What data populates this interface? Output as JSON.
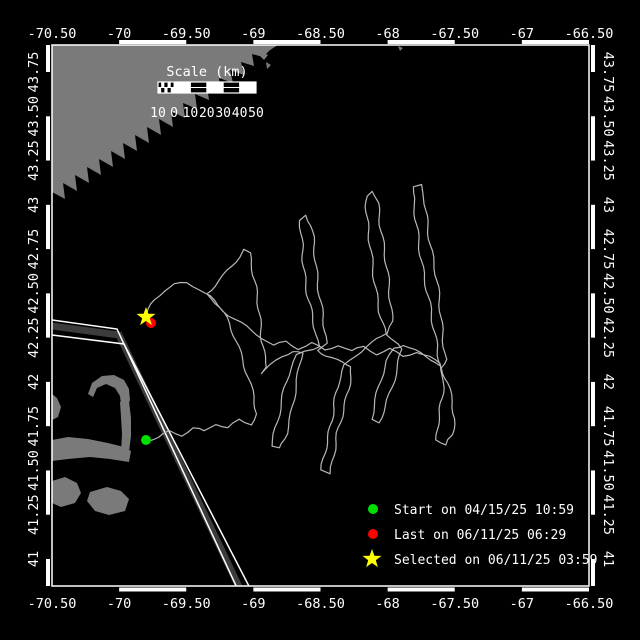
{
  "window": {
    "width": 640,
    "height": 640,
    "background": "#000000"
  },
  "axes": {
    "color": "#ffffff",
    "lon_labels": [
      "-70.50",
      "-70",
      "-69.50",
      "-69",
      "-68.50",
      "-68",
      "-67.50",
      "-67",
      "-66.50"
    ],
    "lat_labels_top_to_bottom": [
      "43.75",
      "43.50",
      "43.25",
      "43",
      "42.75",
      "42.50",
      "42.25",
      "42",
      "41.75",
      "41.50",
      "41.25",
      "41"
    ]
  },
  "scalebar": {
    "title": "Scale (km)",
    "edge_label": "10",
    "zero_label": "0",
    "tick_labels": [
      "10",
      "20",
      "30",
      "40",
      "50"
    ]
  },
  "legend": {
    "items": [
      {
        "marker": "dot",
        "color": "#00e000",
        "label": "Start on 04/15/25 10:59"
      },
      {
        "marker": "dot",
        "color": "#ff0000",
        "label": "Last on 06/11/25 06:29"
      },
      {
        "marker": "star",
        "color": "#ffff00",
        "label": "Selected on 06/11/25 03:59"
      }
    ]
  },
  "map": {
    "land_color": "#7a7a7a",
    "track_color": "#b8b8b8",
    "lane_line_color": "#ffffff",
    "lane_zone_color": "#3c3c3c",
    "markers": {
      "start": {
        "x": 146,
        "y": 440,
        "color": "#00e000"
      },
      "last": {
        "x": 151,
        "y": 323,
        "color": "#ff0000"
      },
      "selected": {
        "x": 146,
        "y": 317,
        "color": "#ffff00"
      }
    },
    "land_polygons": [
      [
        [
          52,
          45
        ],
        [
          278,
          45
        ],
        [
          270,
          50
        ],
        [
          263,
          57
        ],
        [
          252,
          54
        ],
        [
          254,
          66
        ],
        [
          241,
          62
        ],
        [
          244,
          75
        ],
        [
          230,
          70
        ],
        [
          233,
          83
        ],
        [
          219,
          78
        ],
        [
          221,
          92
        ],
        [
          207,
          86
        ],
        [
          209,
          100
        ],
        [
          195,
          94
        ],
        [
          197,
          109
        ],
        [
          183,
          103
        ],
        [
          185,
          118
        ],
        [
          171,
          111
        ],
        [
          173,
          127
        ],
        [
          159,
          119
        ],
        [
          161,
          135
        ],
        [
          147,
          127
        ],
        [
          149,
          143
        ],
        [
          135,
          135
        ],
        [
          137,
          151
        ],
        [
          123,
          143
        ],
        [
          125,
          159
        ],
        [
          111,
          151
        ],
        [
          113,
          167
        ],
        [
          99,
          159
        ],
        [
          101,
          175
        ],
        [
          87,
          167
        ],
        [
          89,
          183
        ],
        [
          75,
          175
        ],
        [
          77,
          191
        ],
        [
          63,
          183
        ],
        [
          65,
          199
        ],
        [
          52,
          192
        ]
      ],
      [
        [
          262,
          52
        ],
        [
          268,
          55
        ],
        [
          264,
          60
        ],
        [
          260,
          56
        ]
      ],
      [
        [
          266,
          62
        ],
        [
          271,
          65
        ],
        [
          267,
          69
        ]
      ],
      [
        [
          398,
          46
        ],
        [
          403,
          48
        ],
        [
          400,
          51
        ]
      ],
      [
        [
          52,
          394
        ],
        [
          57,
          398
        ],
        [
          61,
          407
        ],
        [
          58,
          417
        ],
        [
          52,
          420
        ]
      ],
      [
        [
          88,
          394
        ],
        [
          92,
          383
        ],
        [
          102,
          376
        ],
        [
          114,
          375
        ],
        [
          124,
          380
        ],
        [
          129,
          389
        ],
        [
          130,
          400
        ],
        [
          128,
          405
        ],
        [
          121,
          404
        ],
        [
          120,
          396
        ],
        [
          115,
          388
        ],
        [
          106,
          384
        ],
        [
          97,
          388
        ],
        [
          93,
          397
        ]
      ],
      [
        [
          120,
          402
        ],
        [
          129,
          401
        ],
        [
          131,
          418
        ],
        [
          131,
          436
        ],
        [
          129,
          452
        ],
        [
          121,
          453
        ],
        [
          122,
          434
        ],
        [
          121,
          417
        ]
      ],
      [
        [
          52,
          440
        ],
        [
          68,
          437
        ],
        [
          88,
          439
        ],
        [
          108,
          443
        ],
        [
          124,
          447
        ],
        [
          131,
          451
        ],
        [
          129,
          462
        ],
        [
          110,
          459
        ],
        [
          90,
          457
        ],
        [
          68,
          459
        ],
        [
          52,
          461
        ]
      ],
      [
        [
          52,
          481
        ],
        [
          65,
          477
        ],
        [
          77,
          483
        ],
        [
          81,
          493
        ],
        [
          75,
          503
        ],
        [
          61,
          507
        ],
        [
          52,
          503
        ]
      ],
      [
        [
          90,
          492
        ],
        [
          107,
          487
        ],
        [
          121,
          491
        ],
        [
          129,
          499
        ],
        [
          125,
          511
        ],
        [
          109,
          515
        ],
        [
          95,
          511
        ],
        [
          87,
          501
        ]
      ]
    ],
    "shipping_lane": {
      "line_a": [
        [
          52,
          320
        ],
        [
          117,
          329
        ],
        [
          238,
          590
        ]
      ],
      "zone": [
        [
          52,
          326
        ],
        [
          119,
          335
        ],
        [
          241,
          591
        ]
      ],
      "line_b": [
        [
          52,
          335
        ],
        [
          124,
          344
        ],
        [
          252,
          592
        ]
      ]
    },
    "track_waypoints": [
      [
        146,
        440
      ],
      [
        158,
        437
      ],
      [
        169,
        431
      ],
      [
        181,
        435
      ],
      [
        193,
        428
      ],
      [
        205,
        432
      ],
      [
        216,
        424
      ],
      [
        228,
        428
      ],
      [
        239,
        420
      ],
      [
        250,
        424
      ],
      [
        256,
        414
      ],
      [
        254,
        397
      ],
      [
        249,
        378
      ],
      [
        243,
        359
      ],
      [
        236,
        341
      ],
      [
        229,
        324
      ],
      [
        220,
        308
      ],
      [
        212,
        298
      ],
      [
        207,
        294
      ],
      [
        215,
        286
      ],
      [
        224,
        276
      ],
      [
        232,
        266
      ],
      [
        239,
        256
      ],
      [
        244,
        249
      ],
      [
        250,
        253
      ],
      [
        253,
        270
      ],
      [
        256,
        292
      ],
      [
        259,
        314
      ],
      [
        262,
        336
      ],
      [
        265,
        357
      ],
      [
        267,
        368
      ],
      [
        261,
        373
      ],
      [
        271,
        366
      ],
      [
        282,
        357
      ],
      [
        293,
        351
      ],
      [
        302,
        353
      ],
      [
        299,
        373
      ],
      [
        295,
        393
      ],
      [
        291,
        413
      ],
      [
        286,
        433
      ],
      [
        279,
        449
      ],
      [
        271,
        446
      ],
      [
        275,
        428
      ],
      [
        280,
        408
      ],
      [
        285,
        388
      ],
      [
        291,
        368
      ],
      [
        297,
        356
      ],
      [
        305,
        352
      ],
      [
        313,
        349
      ],
      [
        318,
        347
      ],
      [
        314,
        327
      ],
      [
        310,
        305
      ],
      [
        306,
        283
      ],
      [
        303,
        261
      ],
      [
        301,
        239
      ],
      [
        300,
        221
      ],
      [
        306,
        215
      ],
      [
        311,
        226
      ],
      [
        314,
        248
      ],
      [
        317,
        272
      ],
      [
        320,
        296
      ],
      [
        323,
        320
      ],
      [
        326,
        342
      ],
      [
        318,
        350
      ],
      [
        326,
        355
      ],
      [
        337,
        360
      ],
      [
        347,
        364
      ],
      [
        352,
        367
      ],
      [
        348,
        389
      ],
      [
        343,
        411
      ],
      [
        338,
        433
      ],
      [
        334,
        455
      ],
      [
        330,
        474
      ],
      [
        322,
        470
      ],
      [
        326,
        448
      ],
      [
        330,
        426
      ],
      [
        334,
        404
      ],
      [
        339,
        382
      ],
      [
        345,
        366
      ],
      [
        355,
        356
      ],
      [
        366,
        346
      ],
      [
        377,
        339
      ],
      [
        385,
        334
      ],
      [
        380,
        312
      ],
      [
        376,
        288
      ],
      [
        372,
        264
      ],
      [
        369,
        240
      ],
      [
        367,
        217
      ],
      [
        367,
        196
      ],
      [
        373,
        191
      ],
      [
        378,
        203
      ],
      [
        381,
        225
      ],
      [
        384,
        249
      ],
      [
        387,
        273
      ],
      [
        390,
        297
      ],
      [
        393,
        321
      ],
      [
        388,
        334
      ],
      [
        394,
        342
      ],
      [
        401,
        349
      ],
      [
        397,
        367
      ],
      [
        392,
        387
      ],
      [
        386,
        407
      ],
      [
        379,
        423
      ],
      [
        371,
        419
      ],
      [
        376,
        400
      ],
      [
        381,
        380
      ],
      [
        387,
        361
      ],
      [
        394,
        348
      ],
      [
        404,
        344
      ],
      [
        415,
        350
      ],
      [
        426,
        357
      ],
      [
        436,
        362
      ],
      [
        441,
        366
      ],
      [
        437,
        345
      ],
      [
        432,
        321
      ],
      [
        428,
        297
      ],
      [
        424,
        273
      ],
      [
        420,
        249
      ],
      [
        416,
        225
      ],
      [
        413,
        203
      ],
      [
        414,
        188
      ],
      [
        420,
        185
      ],
      [
        424,
        199
      ],
      [
        427,
        221
      ],
      [
        431,
        245
      ],
      [
        435,
        269
      ],
      [
        438,
        293
      ],
      [
        441,
        317
      ],
      [
        444,
        341
      ],
      [
        446,
        359
      ],
      [
        441,
        368
      ],
      [
        447,
        383
      ],
      [
        452,
        401
      ],
      [
        455,
        419
      ],
      [
        453,
        435
      ],
      [
        445,
        446
      ],
      [
        437,
        440
      ],
      [
        439,
        419
      ],
      [
        442,
        398
      ],
      [
        443,
        377
      ],
      [
        440,
        364
      ],
      [
        429,
        357
      ],
      [
        416,
        351
      ],
      [
        403,
        356
      ],
      [
        390,
        349
      ],
      [
        377,
        354
      ],
      [
        364,
        347
      ],
      [
        351,
        352
      ],
      [
        338,
        345
      ],
      [
        325,
        350
      ],
      [
        312,
        343
      ],
      [
        299,
        348
      ],
      [
        286,
        341
      ],
      [
        273,
        346
      ],
      [
        262,
        338
      ],
      [
        251,
        331
      ],
      [
        240,
        323
      ],
      [
        229,
        315
      ],
      [
        218,
        305
      ],
      [
        210,
        296
      ],
      [
        199,
        288
      ],
      [
        187,
        283
      ],
      [
        175,
        285
      ],
      [
        164,
        291
      ],
      [
        155,
        300
      ],
      [
        149,
        309
      ],
      [
        146,
        316
      ]
    ]
  }
}
